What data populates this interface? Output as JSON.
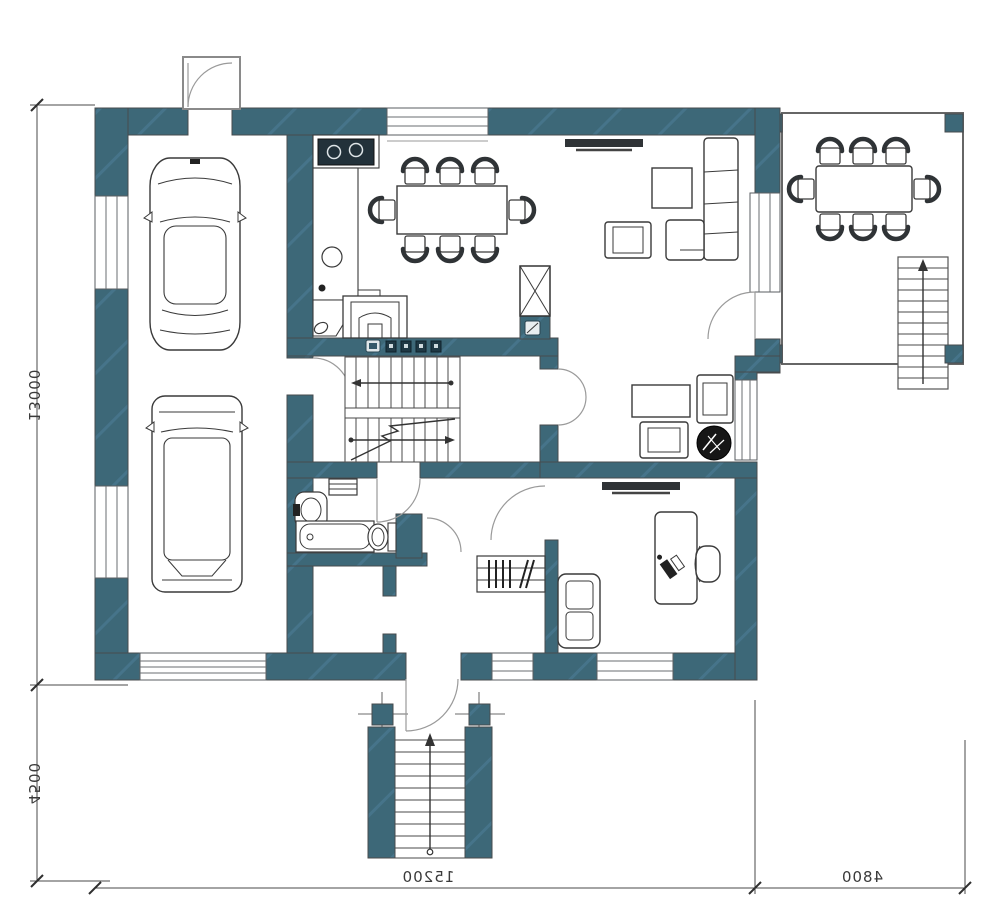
{
  "document": {
    "type": "architectural-floor-plan",
    "floor": "ground-floor",
    "style": "2d-top-view"
  },
  "colors": {
    "wall_fill": "#3d6878",
    "wall_hatch": "#4b7487",
    "paper": "#ffffff",
    "furniture_line": "#3a3a3a",
    "plant_fill": "#161616",
    "dim_line": "#4a4a4a"
  },
  "dimensions": {
    "units": "mm",
    "text_mirrored": true,
    "left_top": {
      "label": "13000"
    },
    "left_bottom": {
      "label": "4500"
    },
    "bottom_main": {
      "label": "15200"
    },
    "bottom_right": {
      "label": "4800"
    }
  },
  "areas": [
    {
      "name": "garage",
      "features": [
        "car-sedan",
        "car-suv",
        "garage-door",
        "side-entrance-porch",
        "window",
        "window"
      ]
    },
    {
      "name": "kitchen-dining",
      "features": [
        "cooktop",
        "counter",
        "round-sink",
        "wood-stove-fireplace",
        "dining-table",
        "chairs-8",
        "window"
      ]
    },
    {
      "name": "living-room",
      "features": [
        "tv",
        "coffee-table",
        "armchair",
        "corner-sofa",
        "terrace-slider",
        "terrace-door"
      ]
    },
    {
      "name": "sitting-room",
      "features": [
        "table",
        "armchair",
        "armchair",
        "potted-plant",
        "double-door",
        "window"
      ]
    },
    {
      "name": "stair-hall",
      "features": [
        "u-shaped-stair",
        "electrical-panel",
        "vent-shaft"
      ]
    },
    {
      "name": "bathroom",
      "features": [
        "bathtub",
        "washbasin",
        "toilet",
        "radiator"
      ]
    },
    {
      "name": "corridor",
      "features": [
        "wardrobe-with-hangers"
      ]
    },
    {
      "name": "office",
      "features": [
        "tv",
        "desk",
        "office-chair",
        "laptop",
        "sofa",
        "window"
      ]
    },
    {
      "name": "entry",
      "features": [
        "entry-door",
        "porch-columns",
        "exterior-stair",
        "window"
      ]
    },
    {
      "name": "terrace",
      "features": [
        "outdoor-table",
        "chairs-8",
        "corner-posts-4",
        "exterior-stair"
      ]
    }
  ]
}
